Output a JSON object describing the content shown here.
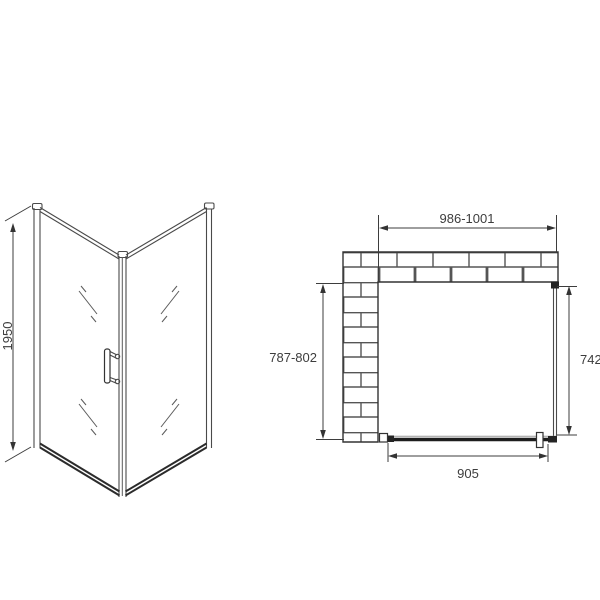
{
  "colors": {
    "background": "#ffffff",
    "drawing_line": "#4a4a4a",
    "dark_line": "#222222",
    "text": "#3d3d3d",
    "brick_mortar": "#555555"
  },
  "elevation_view": {
    "height_dimension_label": "1950"
  },
  "plan_view": {
    "opening_width_label": "986-1001",
    "opening_depth_label": "787-802",
    "side_panel_label": "742",
    "door_width_label": "905"
  }
}
